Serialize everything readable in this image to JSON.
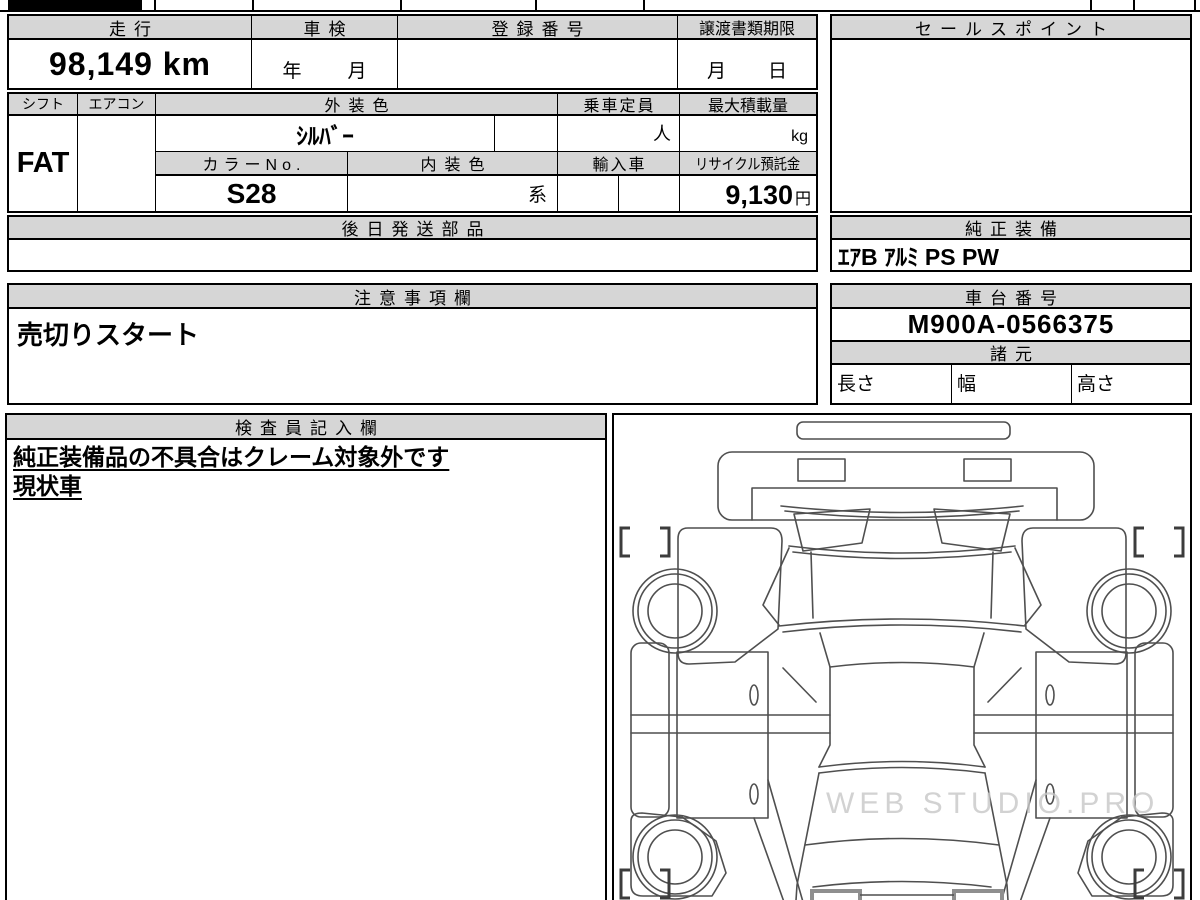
{
  "page": {
    "background": "#ffffff",
    "header_bg": "#d6d6d6",
    "line_color": "#000000"
  },
  "section1": {
    "mileage_header": "走行",
    "mileage_value": "98,149 km",
    "inspection_header": "車検",
    "inspection_year_label": "年",
    "inspection_month_label": "月",
    "registration_header": "登録番号",
    "transfer_docs_header": "譲渡書類期限",
    "transfer_month_label": "月",
    "transfer_day_label": "日",
    "sales_point_header": "セールスポイント"
  },
  "section2": {
    "shift_header": "シフト",
    "shift_value": "FAT",
    "aircon_header": "エアコン",
    "exterior_color_header": "外装色",
    "exterior_color_value": "ｼﾙﾊﾞｰ",
    "color_no_header": "カラーNo.",
    "color_no_value": "S28",
    "interior_color_header": "内装色",
    "interior_color_value": "系",
    "capacity_header": "乗車定員",
    "capacity_unit": "人",
    "max_load_header": "最大積載量",
    "max_load_unit": "kg",
    "import_header": "輸入車",
    "recycle_header": "リサイクル預託金",
    "recycle_value": "9,130",
    "recycle_unit": "円"
  },
  "section3": {
    "later_shipped_parts_header": "後日発送部品",
    "genuine_equipment_header": "純正装備",
    "genuine_equipment_value": "ｴｱB ｱﾙﾐ PS PW"
  },
  "section4": {
    "notes_header": "注意事項欄",
    "notes_value": "売切りスタート",
    "chassis_no_header": "車台番号",
    "chassis_no_value": "M900A-0566375",
    "specs_header": "諸元",
    "length_label": "長さ",
    "width_label": "幅",
    "height_label": "高さ"
  },
  "section5": {
    "inspector_header": "検査員記入欄",
    "inspector_line1": "純正装備品の不具合はクレーム対象外です",
    "inspector_line2": "現状車",
    "diagram_watermark": "WEB STUDIO.PRO"
  }
}
